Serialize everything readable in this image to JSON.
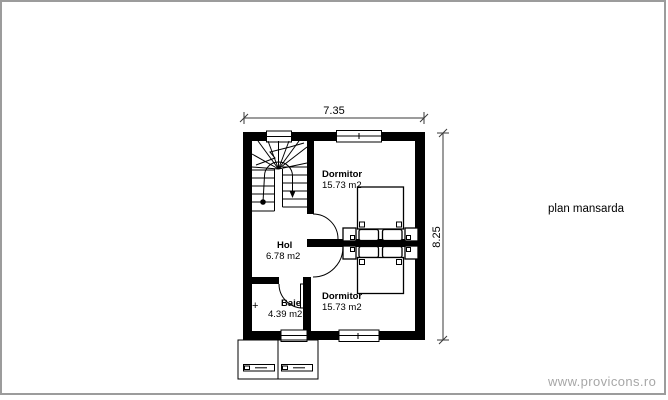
{
  "plan": {
    "title": "plan mansarda",
    "dimensions": {
      "width_m": "7.35",
      "height_m": "8.25"
    },
    "rooms": {
      "dormitor1": {
        "name": "Dormitor",
        "area": "15.73 m2"
      },
      "hol": {
        "name": "Hol",
        "area": "6.78 m2"
      },
      "baie": {
        "name": "Baie",
        "area": "4.39 m2",
        "marker": "+"
      },
      "dormitor2": {
        "name": "Dormitor",
        "area": "15.73 m2"
      }
    }
  },
  "footer": {
    "website": "www.provicons.ro"
  },
  "colors": {
    "walls": "#000000",
    "frame_border": "#9c9c9c",
    "watermark_text": "#a7a7a7"
  }
}
